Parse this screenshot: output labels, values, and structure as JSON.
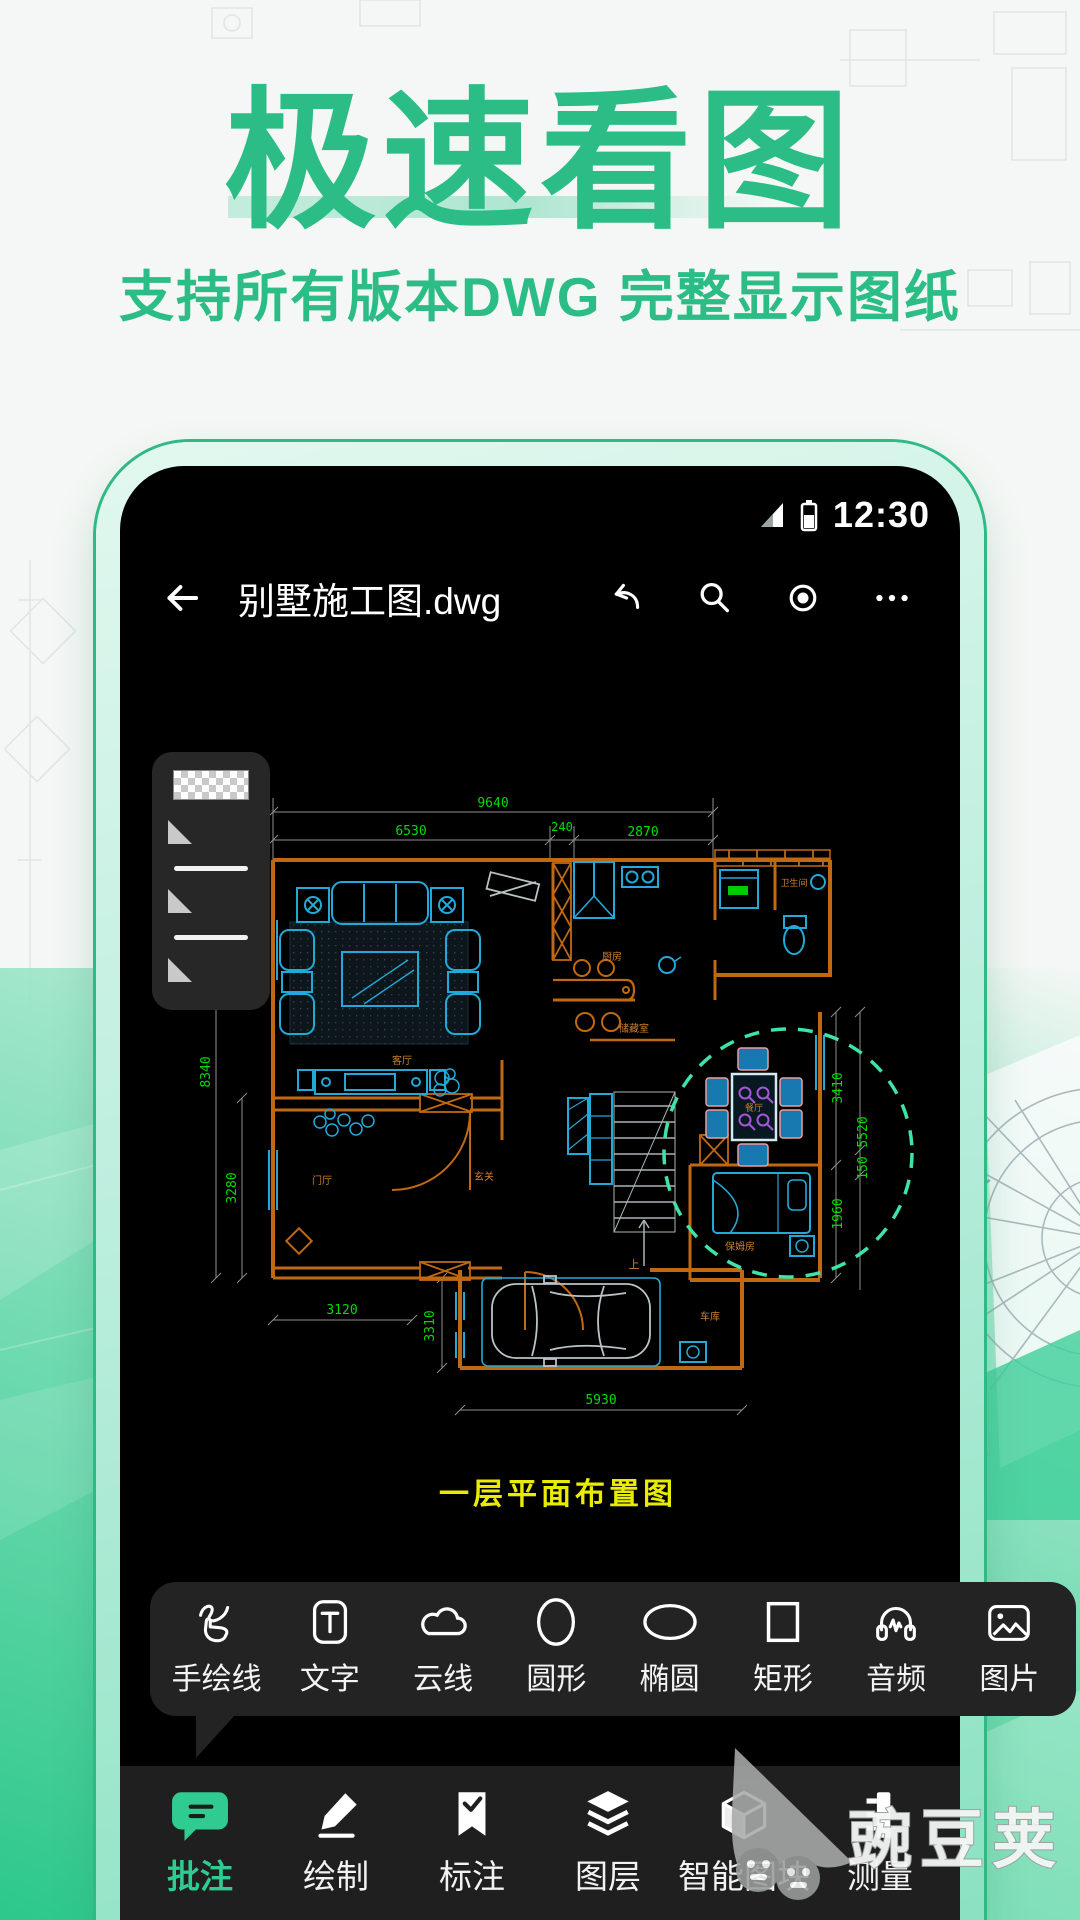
{
  "hero": {
    "title": "极速看图",
    "subtitle": "支持所有版本DWG 完整显示图纸",
    "accent_color": "#2cbd86"
  },
  "statusbar": {
    "time": "12:30",
    "icons": [
      "signal-icon",
      "battery-icon"
    ]
  },
  "appbar": {
    "file_name": "别墅施工图.dwg",
    "back_icon": "back-arrow-icon",
    "action_icons": [
      "undo-icon",
      "search-icon",
      "record-icon",
      "more-icon"
    ]
  },
  "style_panel": {
    "items": [
      "transparent-checker-swatch",
      "triangle-marker",
      "line-sample",
      "triangle-marker",
      "line-sample",
      "triangle-marker"
    ]
  },
  "drawing": {
    "caption": "一层平面布置图",
    "caption_color": "#e9eb00",
    "wall_color": "#c06812",
    "furniture_color": "#22a9d8",
    "dim_color": "#00dc00",
    "highlight_color": "#3fe3a8",
    "dims": {
      "total_width": "9640",
      "left_width": "6530",
      "mid_width": "240",
      "right_width": "2870",
      "left_height_upper": "8340",
      "left_height_lower": "3280",
      "right_height_upper": "3410",
      "right_height_mid": "5520",
      "right_height_small": "150",
      "right_height_lower": "1960",
      "bottom_left_width": "3120",
      "bottom_mid_height": "3310",
      "garage_width": "5930"
    },
    "rooms": {
      "living": "客厅",
      "kitchen": "厨房",
      "bathroom": "卫生间",
      "dining": "餐厅",
      "foyer": "门厅",
      "entry": "玄关",
      "storage": "储藏室",
      "nanny": "保姆房",
      "garage": "车库",
      "stairs_up": "上"
    }
  },
  "popup_tools": {
    "items": [
      {
        "label": "手绘线",
        "icon": "freehand-line-icon"
      },
      {
        "label": "文字",
        "icon": "text-icon"
      },
      {
        "label": "云线",
        "icon": "cloud-line-icon"
      },
      {
        "label": "圆形",
        "icon": "circle-icon"
      },
      {
        "label": "椭圆",
        "icon": "ellipse-icon"
      },
      {
        "label": "矩形",
        "icon": "rectangle-icon"
      },
      {
        "label": "音频",
        "icon": "audio-icon"
      },
      {
        "label": "图片",
        "icon": "image-icon"
      }
    ]
  },
  "tabbar": {
    "items": [
      {
        "label": "批注",
        "icon": "comment-bubble-icon",
        "active": true
      },
      {
        "label": "绘制",
        "icon": "pencil-icon",
        "active": false
      },
      {
        "label": "标注",
        "icon": "bookmark-check-icon",
        "active": false
      },
      {
        "label": "图层",
        "icon": "layers-icon",
        "active": false
      },
      {
        "label": "智能图块",
        "icon": "cube-icon",
        "active": false
      },
      {
        "label": "测量",
        "icon": "ruler-icon",
        "active": false
      }
    ],
    "active_color": "#2fcb90"
  },
  "watermark": {
    "text": "豌豆荚"
  }
}
